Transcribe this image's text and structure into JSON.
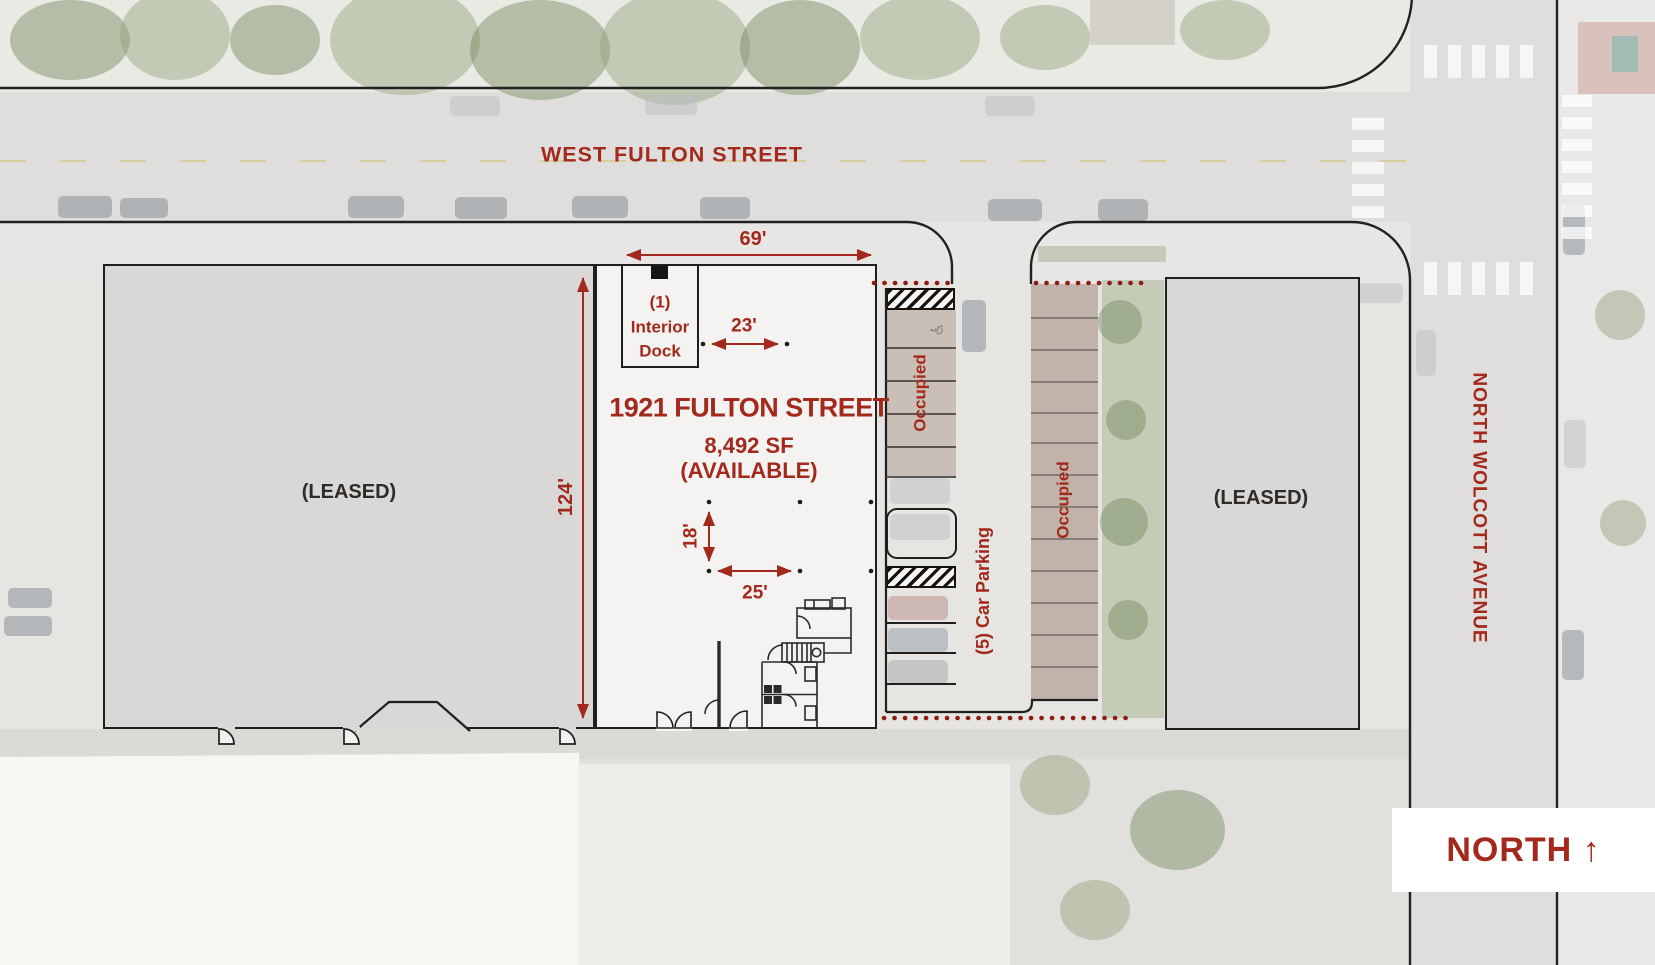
{
  "colors": {
    "accent_red": "#A2291B",
    "boundary_dot_red": "#8E1B10",
    "plan_line": "#1F1F1F",
    "leased_fill": "#D9D8D6",
    "available_fill": "#F4F3F1",
    "occupied_stall_fill": "#B49C8E"
  },
  "streets": {
    "top": "WEST FULTON STREET",
    "right": "NORTH WOLCOTT AVENUE"
  },
  "compass": {
    "label": "NORTH ↑"
  },
  "buildings": {
    "left": {
      "label": "(LEASED)"
    },
    "right": {
      "label": "(LEASED)"
    }
  },
  "unit": {
    "title": "1921 FULTON STREET",
    "area": "8,492 SF",
    "status": "(AVAILABLE)",
    "dock": {
      "line1": "(1)",
      "line2": "Interior",
      "line3": "Dock"
    }
  },
  "dimensions": {
    "frontage": "69'",
    "depth": "124'",
    "dock_width": "23'",
    "bay_depth": "18'",
    "bay_width": "25'"
  },
  "parking": {
    "north_lot_label": "Occupied",
    "east_lot_label": "Occupied",
    "available_label": "(5) Car Parking",
    "handicap_icon": "♿"
  }
}
